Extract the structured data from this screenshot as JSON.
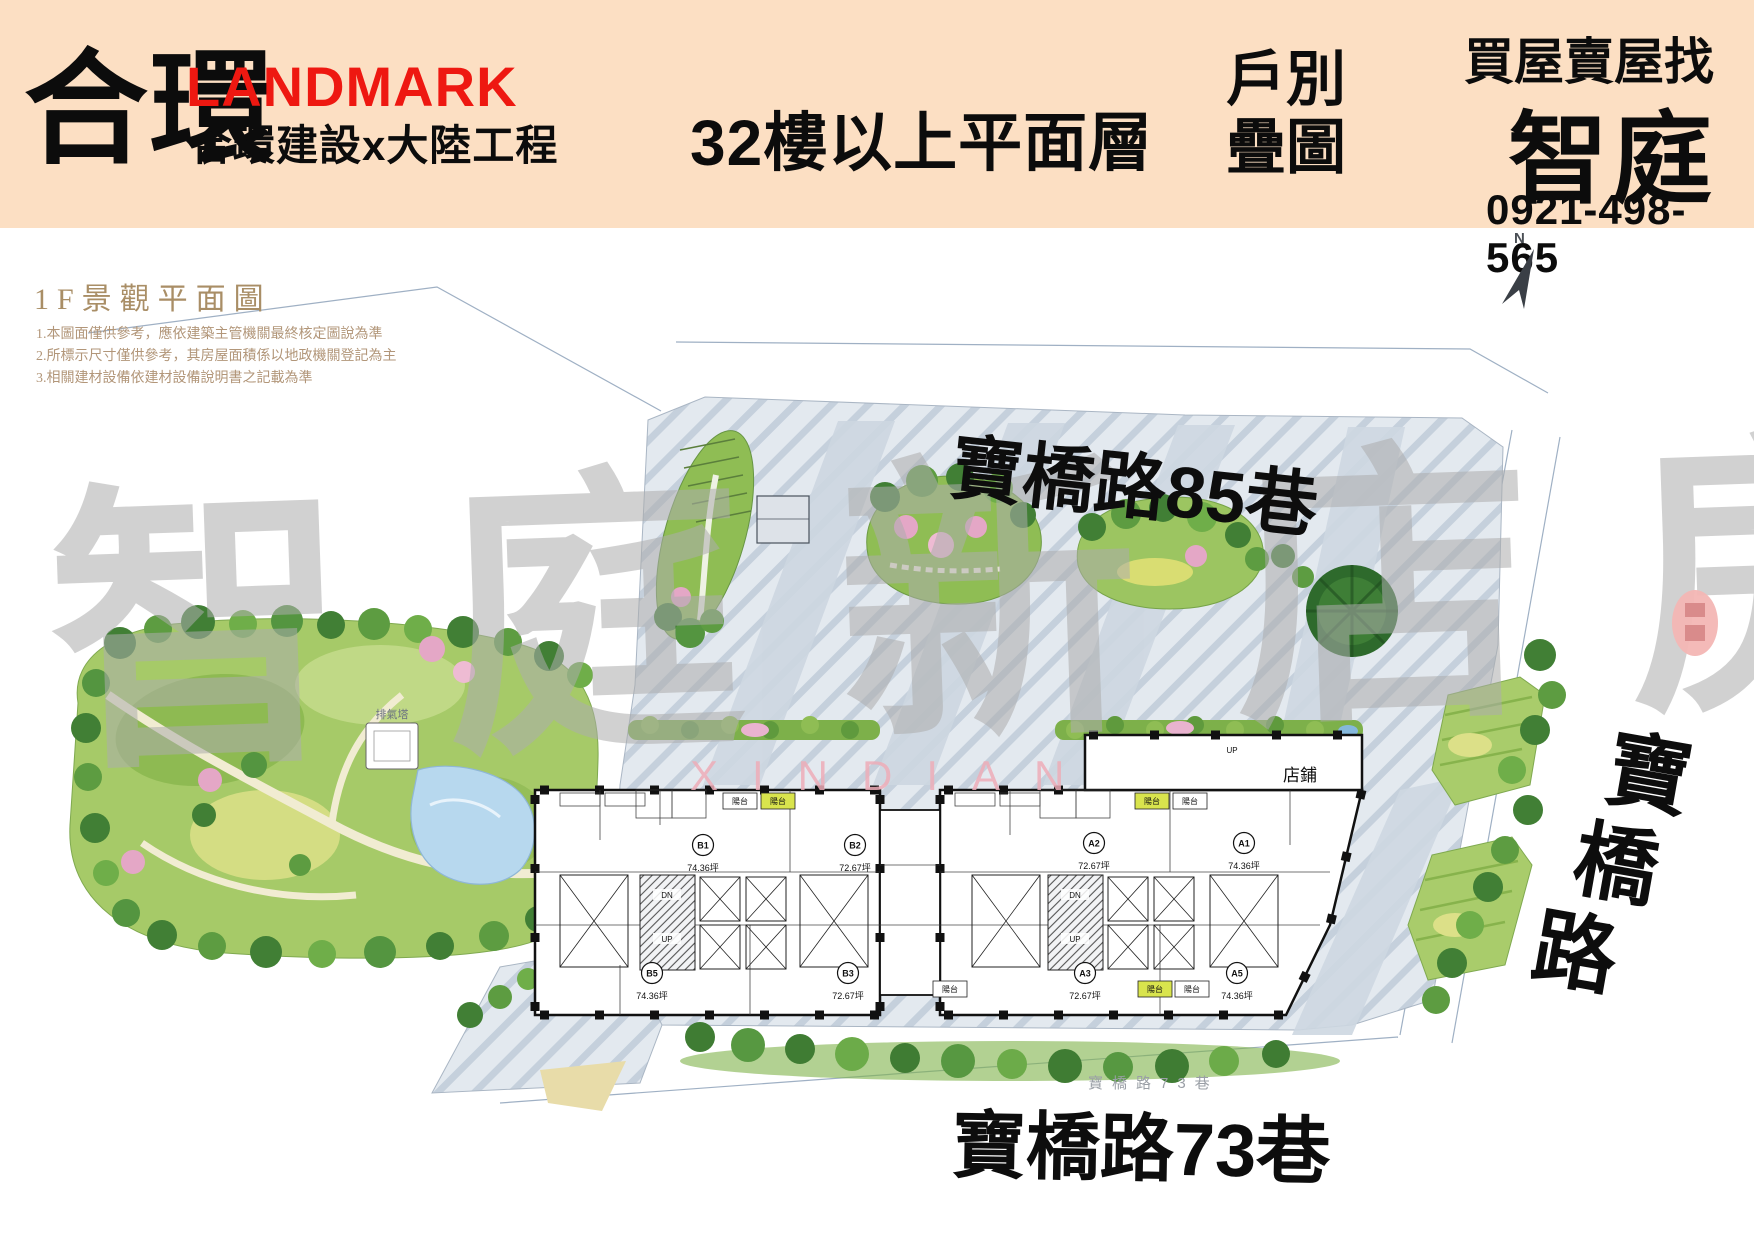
{
  "header": {
    "brand": {
      "name": "合環",
      "sub_brand": "LANDMARK",
      "companies": "合環建設x大陸工程"
    },
    "title": "32樓以上平面層",
    "stack": {
      "line1": "戶別",
      "line2": "疊圖"
    },
    "agency": {
      "tagline": "買屋賣屋找",
      "name": "智庭",
      "phone": "0921-498-565"
    }
  },
  "plan": {
    "section_title": "1F景觀平面圖",
    "notes": [
      "1.本圖面僅供參考，應依建築主管機關最終核定圖說為準",
      "2.所標示尺寸僅供參考，其房屋面積係以地政機關登記為主",
      "3.相關建材設備依建材設備說明書之記載為準"
    ],
    "compass_label": "N",
    "streets": {
      "top": "寶橋路85巷",
      "bottom": "寶橋路73巷",
      "bottom_small": "寶橋路73巷",
      "right_vertical": [
        "寶",
        "橋",
        "路"
      ]
    },
    "labels": {
      "shop": "店鋪",
      "balcony": "陽台",
      "vent": "排氣塔",
      "up": "UP",
      "dn": "DN"
    },
    "units": [
      {
        "id": "B1",
        "area": "74.36坪",
        "x": 703,
        "y": 845
      },
      {
        "id": "B2",
        "area": "72.67坪",
        "x": 855,
        "y": 845
      },
      {
        "id": "A2",
        "area": "72.67坪",
        "x": 1094,
        "y": 843
      },
      {
        "id": "A1",
        "area": "74.36坪",
        "x": 1244,
        "y": 843
      },
      {
        "id": "B5",
        "area": "74.36坪",
        "x": 652,
        "y": 973
      },
      {
        "id": "B3",
        "area": "72.67坪",
        "x": 848,
        "y": 973
      },
      {
        "id": "A3",
        "area": "72.67坪",
        "x": 1085,
        "y": 973
      },
      {
        "id": "A5",
        "area": "74.36坪",
        "x": 1237,
        "y": 973
      }
    ],
    "balconies": [
      {
        "x": 740,
        "y": 801,
        "highlight": false
      },
      {
        "x": 778,
        "y": 801,
        "highlight": true
      },
      {
        "x": 1152,
        "y": 801,
        "highlight": true
      },
      {
        "x": 1190,
        "y": 801,
        "highlight": false
      },
      {
        "x": 950,
        "y": 989,
        "highlight": false
      },
      {
        "x": 1155,
        "y": 989,
        "highlight": true
      },
      {
        "x": 1192,
        "y": 989,
        "highlight": false
      }
    ]
  },
  "watermark": {
    "text": "智庭新店房屋網",
    "subtext": "XINDIAN"
  },
  "colors": {
    "header_bg": "#fcdfc3",
    "brand_red": "#ee1811",
    "ink": "#0c0c0c",
    "plan_title_brown": "#a98e66",
    "note_brown": "#b29679",
    "watermark_gray": "#adadad",
    "watermark_pink": "#eeadb8",
    "paving": "#e3e9ef",
    "park_green": "#a6ca68",
    "balcony_highlight": "#d9e44d",
    "seal_red": "#f3b6b4"
  }
}
